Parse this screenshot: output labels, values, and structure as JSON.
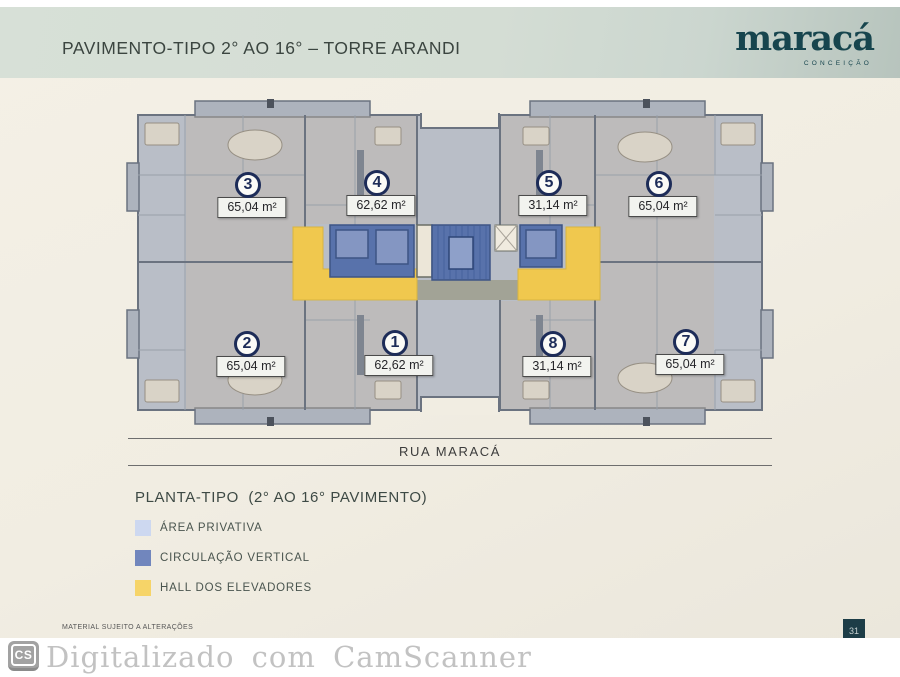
{
  "header": {
    "title": "PAVIMENTO-TIPO 2° AO 16° – TORRE ARANDI",
    "brand": {
      "name": "maracá",
      "subtitle": "CONCEIÇÃO"
    }
  },
  "floor_plan": {
    "street_label": "RUA MARACÁ",
    "units": [
      {
        "number": "3",
        "area": "65,04 m²"
      },
      {
        "number": "4",
        "area": "62,62 m²"
      },
      {
        "number": "5",
        "area": "31,14 m²"
      },
      {
        "number": "6",
        "area": "65,04 m²"
      },
      {
        "number": "2",
        "area": "65,04 m²"
      },
      {
        "number": "1",
        "area": "62,62 m²"
      },
      {
        "number": "8",
        "area": "31,14 m²"
      },
      {
        "number": "7",
        "area": "65,04 m²"
      }
    ]
  },
  "legend": {
    "title": "PLANTA-TIPO  (2° AO 16° PAVIMENTO)",
    "items": [
      {
        "label": "ÁREA PRIVATIVA",
        "color": "#cdd8f0"
      },
      {
        "label": "CIRCULAÇÃO VERTICAL",
        "color": "#7186bd"
      },
      {
        "label": "HALL DOS ELEVADORES",
        "color": "#f6d468"
      }
    ]
  },
  "footer": {
    "disclaimer": "MATERIAL SUJEITO A ALTERAÇÕES",
    "page_number": "31"
  },
  "watermark": {
    "icon_label": "CS",
    "text": "Digitalizado com CamScanner"
  },
  "colors": {
    "brand_teal": "#17454e",
    "header_band": "#d4ddd4",
    "page_cream": "#f1ede2",
    "unit_badge_navy": "#1d2c58"
  }
}
